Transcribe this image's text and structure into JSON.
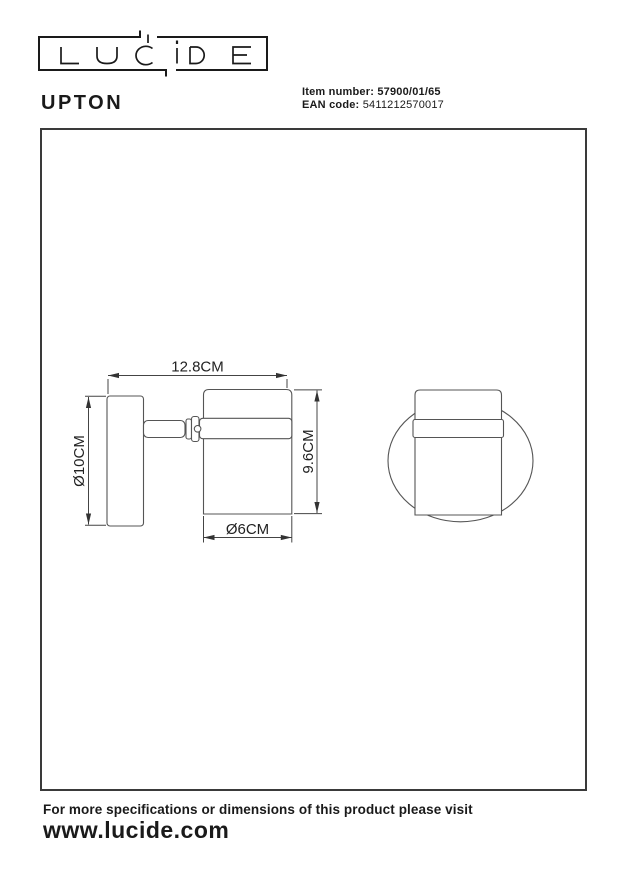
{
  "brand": {
    "logo_text": "LUCIDE"
  },
  "product": {
    "name": "UPTON"
  },
  "item": {
    "label": "Item number:",
    "value": "57900/01/65"
  },
  "ean": {
    "label": "EAN code:",
    "value": "5411212570017"
  },
  "drawing": {
    "dim_width": "12.8CM",
    "dim_plate_diameter": "Ø10CM",
    "dim_height": "9.6CM",
    "dim_head_diameter": "Ø6CM"
  },
  "footer": {
    "line1": "For more specifications or dimensions of this product please visit",
    "url": "www.lucide.com"
  },
  "colors": {
    "line": "#555555",
    "dim": "#444444",
    "text": "#1a1a1a"
  }
}
